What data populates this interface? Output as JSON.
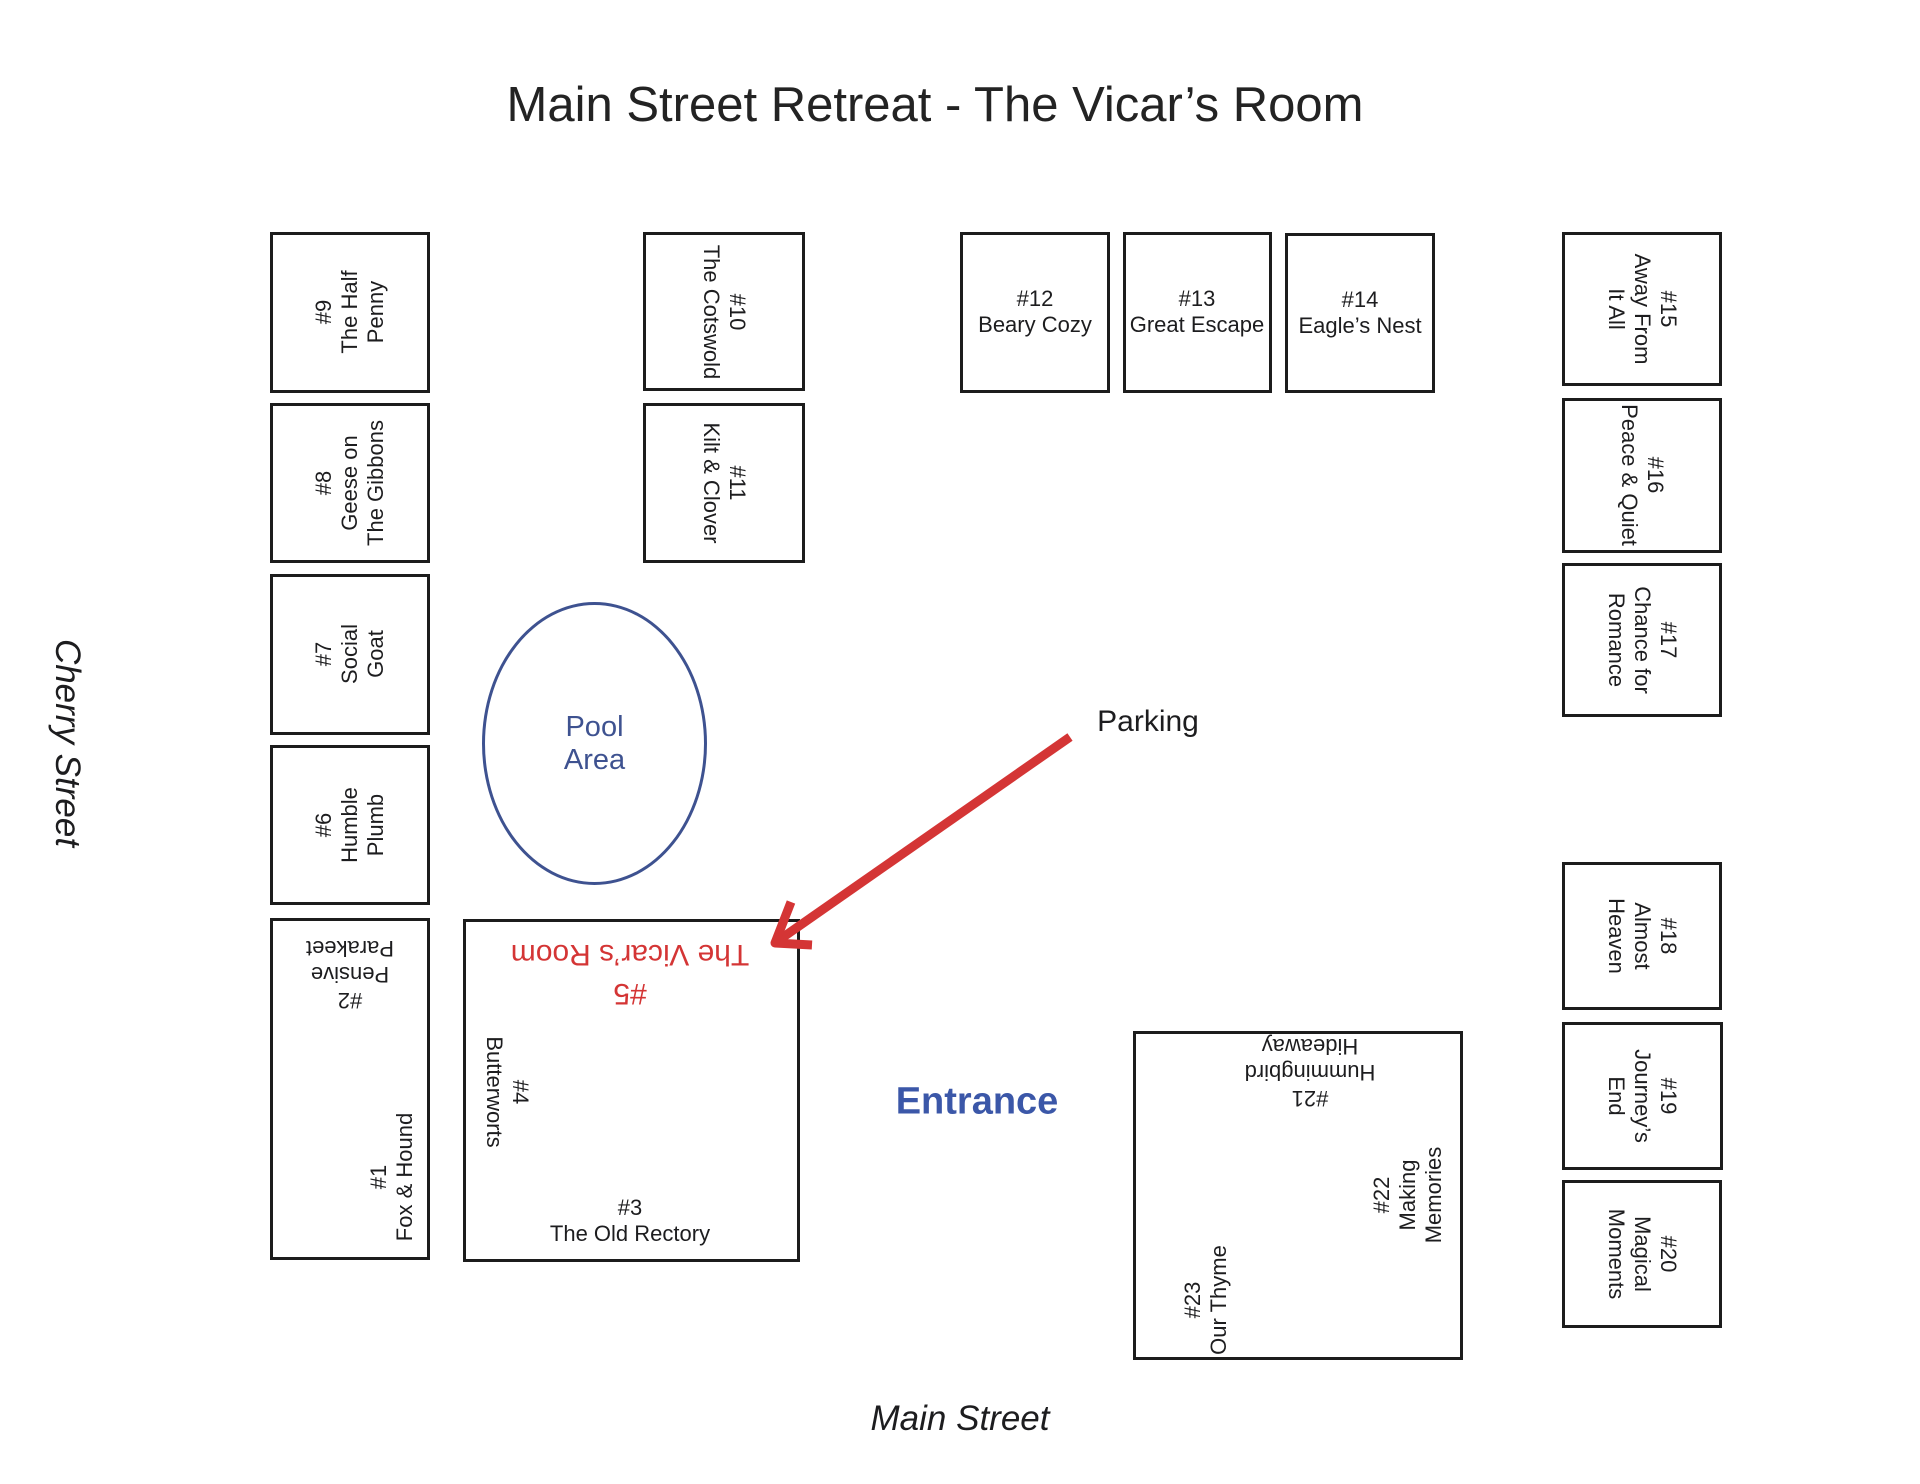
{
  "title": "Main Street Retreat - The Vicar’s Room",
  "streets": {
    "left": "Cherry Street",
    "bottom": "Main Street"
  },
  "labels": {
    "parking": "Parking",
    "entrance": "Entrance",
    "pool": "Pool\nArea"
  },
  "colors": {
    "ink": "#1d1d1f",
    "accent_red": "#d43535",
    "entrance_blue": "#3b57a8",
    "pool_blue": "#3e5290"
  },
  "rooms": [
    {
      "number": "#1",
      "name": "Fox & Hound",
      "text": "#1\nFox & Hound"
    },
    {
      "number": "#2",
      "name": "Pensive Parakeet",
      "text": "#2\nPensive\nParakeet"
    },
    {
      "number": "#3",
      "name": "The Old Rectory",
      "text": "#3\nThe Old Rectory"
    },
    {
      "number": "#4",
      "name": "Butterworts",
      "text": "#4\nButterworts"
    },
    {
      "number": "#5",
      "name": "The Vicar’s Room",
      "text": "#5\nThe Vicar’s Room"
    },
    {
      "number": "#6",
      "name": "Humble Plumb",
      "text": "#6\nHumble\nPlumb"
    },
    {
      "number": "#7",
      "name": "Social Goat",
      "text": "#7\nSocial\nGoat"
    },
    {
      "number": "#8",
      "name": "Geese on The Gibbons",
      "text": "#8\nGeese on\nThe Gibbons"
    },
    {
      "number": "#9",
      "name": "The Half Penny",
      "text": "#9\nThe Half\nPenny"
    },
    {
      "number": "#10",
      "name": "The Cotswold",
      "text": "#10\nThe Cotswold"
    },
    {
      "number": "#11",
      "name": "Kilt & Clover",
      "text": "#11\nKilt & Clover"
    },
    {
      "number": "#12",
      "name": "Beary Cozy",
      "text": "#12\nBeary Cozy"
    },
    {
      "number": "#13",
      "name": "Great Escape",
      "text": "#13\nGreat Escape"
    },
    {
      "number": "#14",
      "name": "Eagle’s Nest",
      "text": "#14\nEagle’s Nest"
    },
    {
      "number": "#15",
      "name": "Away From It All",
      "text": "#15\nAway From\nIt All"
    },
    {
      "number": "#16",
      "name": "Peace & Quiet",
      "text": "#16\nPeace & Quiet"
    },
    {
      "number": "#17",
      "name": "Chance for Romance",
      "text": "#17\nChance for\nRomance"
    },
    {
      "number": "#18",
      "name": "Almost Heaven",
      "text": "#18\nAlmost\nHeaven"
    },
    {
      "number": "#19",
      "name": "Journey’s End",
      "text": "#19\nJourney’s\nEnd"
    },
    {
      "number": "#20",
      "name": "Magical Moments",
      "text": "#20\nMagical\nMoments"
    },
    {
      "number": "#21",
      "name": "Hummingbird Hideaway",
      "text": "#21\nHummingbird\nHideaway"
    },
    {
      "number": "#22",
      "name": "Making Memories",
      "text": "#22\nMaking\nMemories"
    },
    {
      "number": "#23",
      "name": "Our Thyme",
      "text": "#23\nOur Thyme"
    }
  ]
}
